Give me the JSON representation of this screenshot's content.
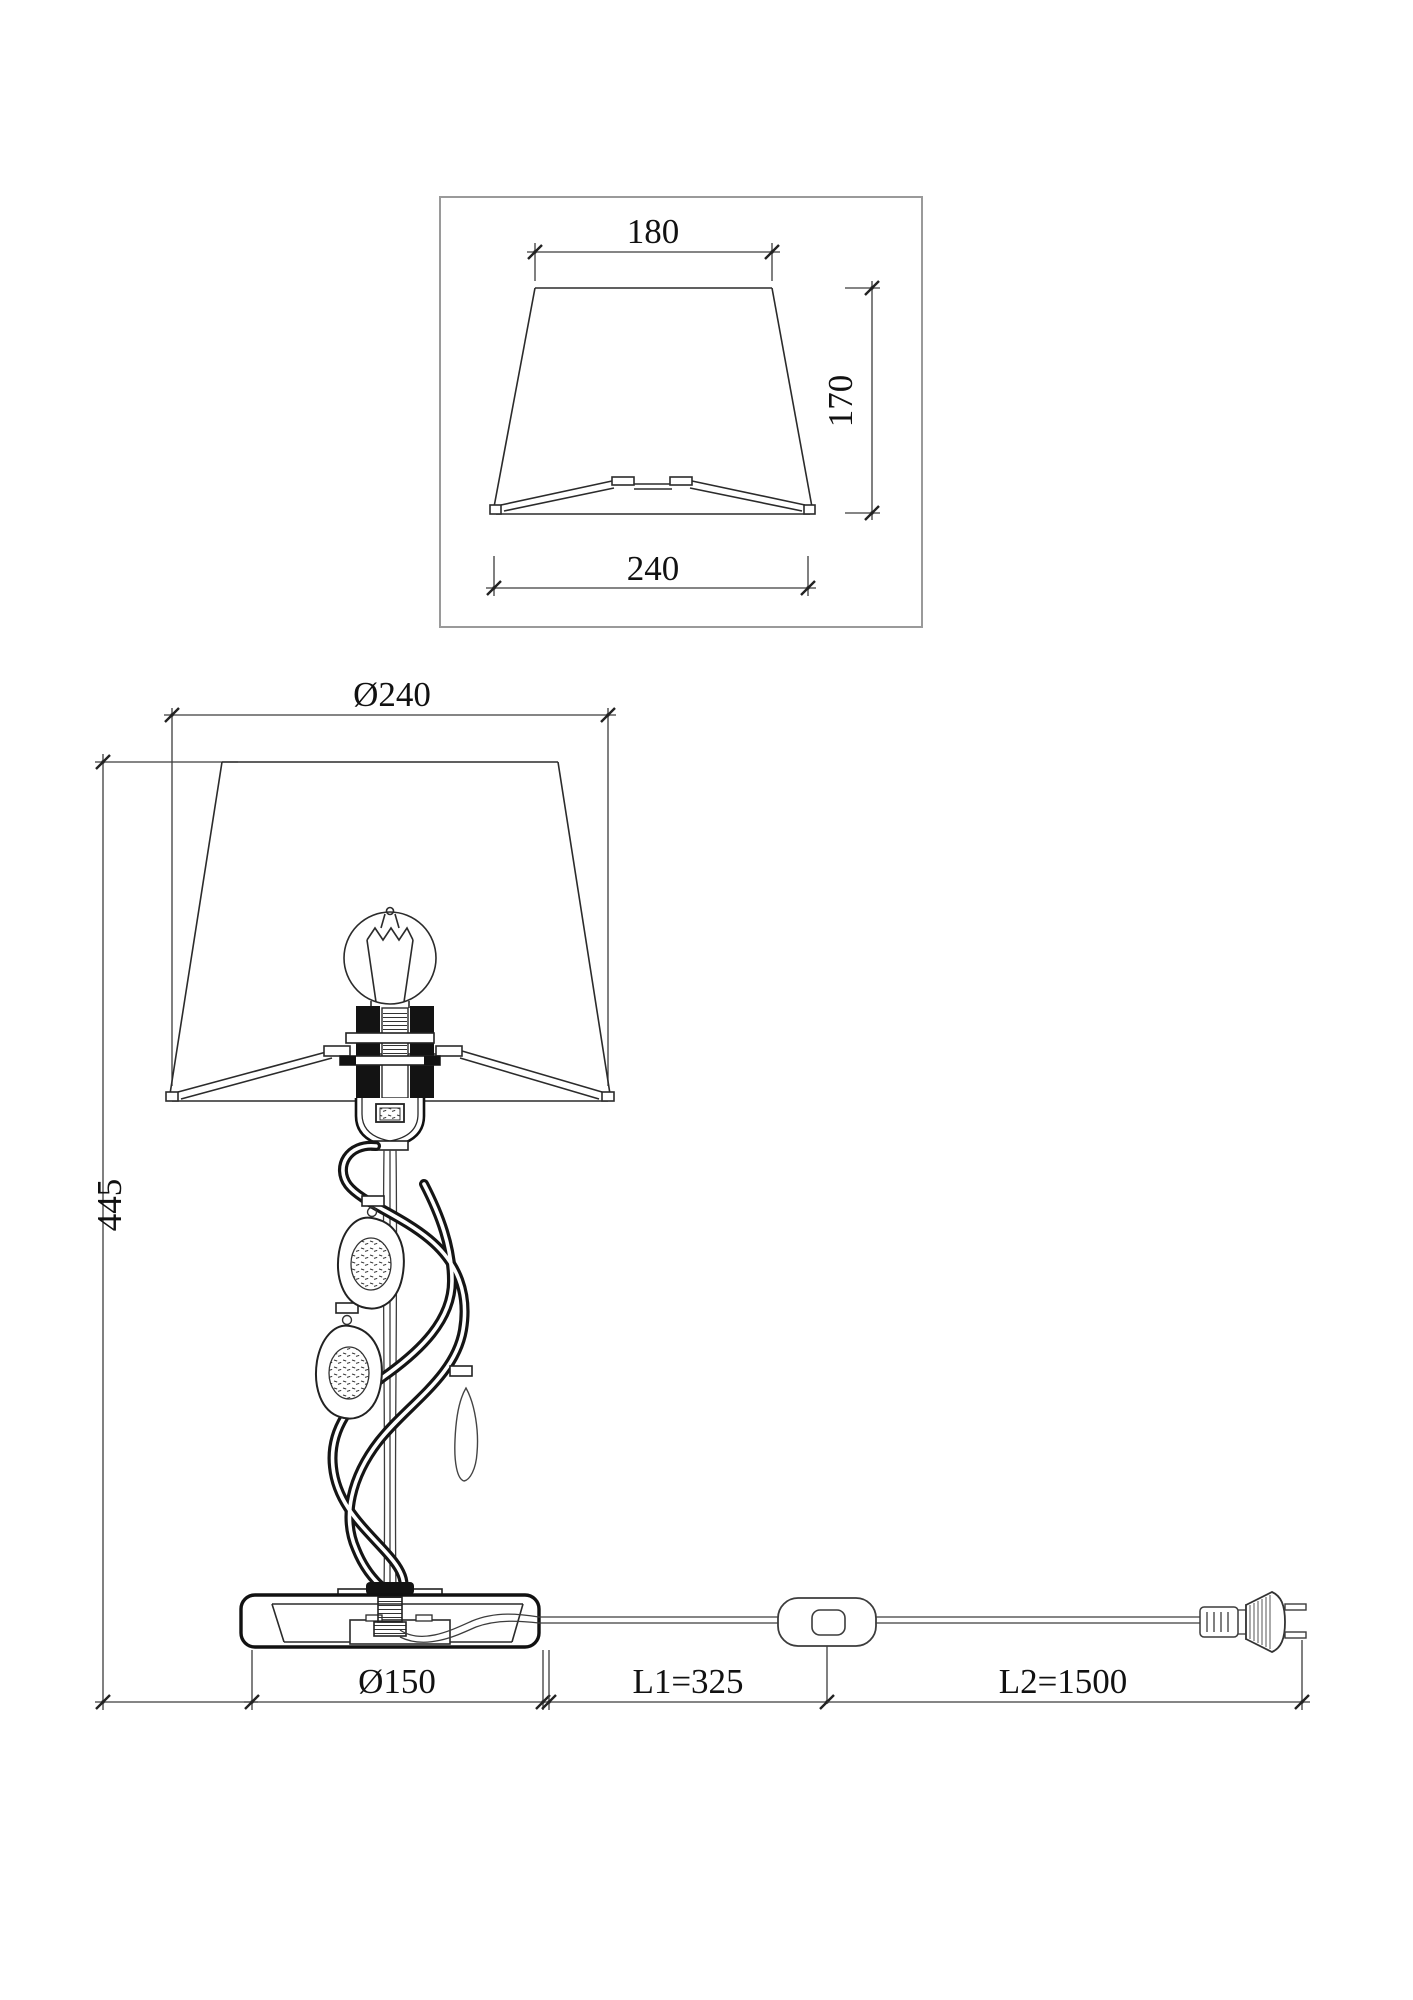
{
  "page": {
    "background": "#ffffff",
    "line_color": "#2b2b2b",
    "dim_line_color": "#3c3c3c",
    "frame_color": "#9a9a9a",
    "text_color": "#111111"
  },
  "shade_detail": {
    "dims": {
      "top_width": "180",
      "height": "170",
      "bottom_width": "240"
    }
  },
  "lamp_view": {
    "dims": {
      "shade_diameter": "Ø240",
      "total_height": "445",
      "base_diameter": "Ø150",
      "cord_l1": "L1=325",
      "cord_l2": "L2=1500"
    }
  }
}
